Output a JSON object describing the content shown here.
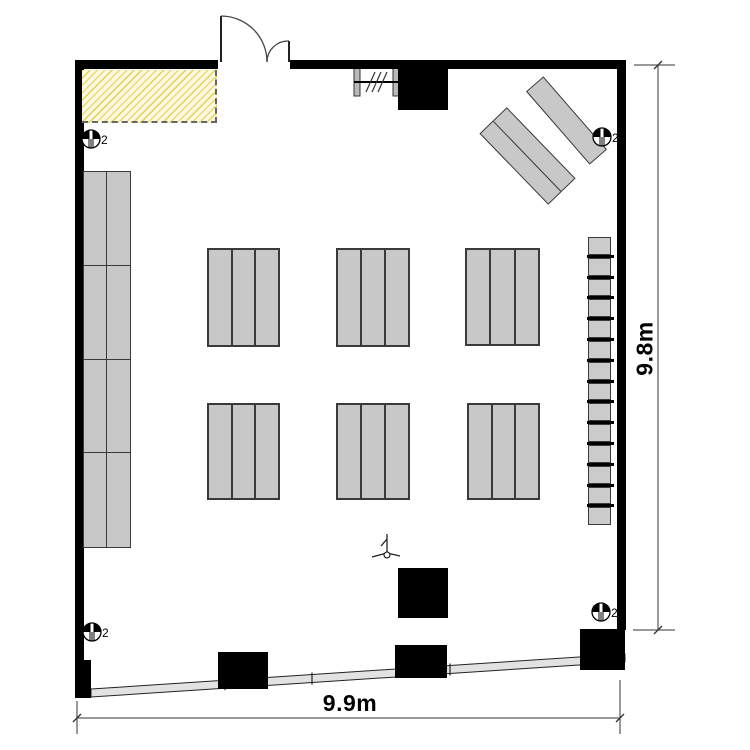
{
  "page": {
    "background": "#ffffff",
    "width": 750,
    "height": 750
  },
  "dimensions": {
    "bottom_label": "9.9m",
    "right_label": "9.8m"
  },
  "colors": {
    "wall": "#000000",
    "desk_fill": "#c8c8c8",
    "desk_border": "#3a3a3a",
    "hatch_bg": "#fcf8e1",
    "hatch_line": "#e5d14f",
    "hatch_border": "#666666",
    "band_fill": "#e2e2e2",
    "line": "#222222",
    "dim": "#333333",
    "window_bar": "#b9b9b9"
  },
  "floorplan": {
    "walls": [
      {
        "id": "top-left",
        "x": 75,
        "y": 60,
        "w": 143,
        "h": 9
      },
      {
        "id": "top-right",
        "x": 290,
        "y": 60,
        "w": 336,
        "h": 9
      },
      {
        "id": "left",
        "x": 75,
        "y": 60,
        "w": 9,
        "h": 602
      },
      {
        "id": "right",
        "x": 617,
        "y": 60,
        "w": 9,
        "h": 570
      }
    ],
    "columns": [
      {
        "x": 398,
        "y": 61,
        "w": 50,
        "h": 49
      },
      {
        "x": 398,
        "y": 568,
        "w": 50,
        "h": 50
      },
      {
        "x": 218,
        "y": 652,
        "w": 50,
        "h": 37
      },
      {
        "x": 395,
        "y": 645,
        "w": 52,
        "h": 33
      },
      {
        "x": 580,
        "y": 629,
        "w": 45,
        "h": 41
      },
      {
        "x": 75,
        "y": 660,
        "w": 16,
        "h": 38
      }
    ],
    "hatch_area": {
      "x": 82,
      "y": 70,
      "w": 135,
      "h": 53
    },
    "door": {
      "leaf1": [
        221,
        16,
        221,
        62
      ],
      "leaf2": [
        289,
        41,
        289,
        62
      ],
      "arc1": "M 221 16 A 46 46 0 0 1 267 62",
      "arc2": "M 289 41 A 21 21 0 0 0 267 62"
    },
    "window": {
      "bars": [
        [
          354,
          68
        ],
        [
          393,
          68
        ]
      ],
      "bar_w": 6,
      "bar_h": 28,
      "rail": [
        354,
        82,
        399,
        82
      ],
      "slashes": [
        [
          366,
          92,
          375,
          72
        ],
        [
          372,
          92,
          381,
          72
        ],
        [
          378,
          92,
          387,
          72
        ]
      ]
    },
    "desk_groups": [
      {
        "x": 207,
        "y": 248,
        "w": 73,
        "h": 99,
        "segments": 3
      },
      {
        "x": 336,
        "y": 248,
        "w": 74,
        "h": 99,
        "segments": 3
      },
      {
        "x": 465,
        "y": 248,
        "w": 75,
        "h": 98,
        "segments": 3
      },
      {
        "x": 207,
        "y": 403,
        "w": 73,
        "h": 97,
        "segments": 3
      },
      {
        "x": 336,
        "y": 403,
        "w": 74,
        "h": 97,
        "segments": 3
      },
      {
        "x": 467,
        "y": 403,
        "w": 73,
        "h": 97,
        "segments": 3
      }
    ],
    "left_bank": {
      "x": 83,
      "y": 171,
      "w": 48,
      "h": 377,
      "cols": 2,
      "rows": 4
    },
    "right_strip": {
      "x": 587,
      "y": 237,
      "w": 27,
      "count": 14,
      "cell_h": 17.8,
      "bar_h": 3
    },
    "angled_desks": [
      {
        "cx": 566,
        "cy": 120,
        "len": 97,
        "wid": 23,
        "angle": 49,
        "rows": 1
      },
      {
        "cx": 527,
        "cy": 156,
        "len": 99,
        "wid": 38,
        "angle": 46,
        "rows": 2
      }
    ],
    "fixtures": {
      "label": "2",
      "radius": 9,
      "positions": [
        [
          91,
          139
        ],
        [
          602,
          137
        ],
        [
          92,
          632
        ],
        [
          601,
          612
        ]
      ]
    },
    "pointer": {
      "mast": [
        387,
        534,
        387,
        553
      ],
      "flag": [
        387,
        539,
        381,
        546
      ],
      "legs": [
        [
          387,
          553,
          372,
          557
        ],
        [
          387,
          553,
          400,
          556
        ]
      ],
      "foot": [
        387,
        555,
        3
      ]
    },
    "band": {
      "points": "91,689 625,654 625,662 91,697",
      "ticks": [
        225,
        312,
        450
      ]
    },
    "dim_bottom": {
      "line": [
        77,
        718,
        620,
        718
      ],
      "ext": [
        [
          77,
          701,
          77,
          734
        ],
        [
          620,
          680,
          620,
          734
        ]
      ],
      "ticks": [
        [
          77,
          718
        ],
        [
          620,
          718
        ]
      ],
      "label_cx": 350,
      "label_cy": 703
    },
    "dim_right": {
      "line": [
        658,
        65,
        658,
        630
      ],
      "ext": [
        [
          634,
          65,
          675,
          65
        ],
        [
          633,
          630,
          675,
          630
        ]
      ],
      "ticks": [
        [
          658,
          65
        ],
        [
          658,
          630
        ]
      ],
      "label_cx": 645,
      "label_cy": 348
    }
  }
}
